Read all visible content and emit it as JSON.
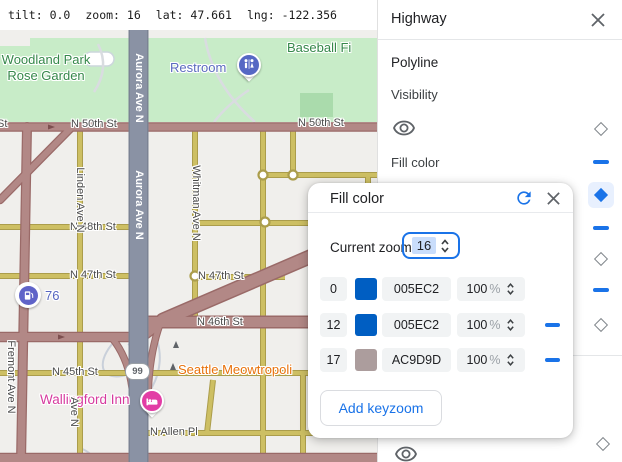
{
  "topbar": {
    "stats": [
      {
        "label": "tilt:",
        "value": "0.0"
      },
      {
        "label": "zoom:",
        "value": "16"
      },
      {
        "label": "lat:",
        "value": "47.661"
      },
      {
        "label": "lng:",
        "value": "-122.356"
      }
    ]
  },
  "panel": {
    "title": "Highway",
    "polyline_label": "Polyline",
    "visibility_label": "Visibility",
    "fill_color_label": "Fill color"
  },
  "dialog": {
    "title": "Fill color",
    "current_zoom_label": "Current zoom",
    "current_zoom_value": "16",
    "percent_suffix": "%",
    "add_button_label": "Add keyzoom",
    "rows": [
      {
        "zoom": "0",
        "hex": "005EC2",
        "swatch": "#005EC2",
        "opacity": "100",
        "removable": false
      },
      {
        "zoom": "12",
        "hex": "005EC2",
        "swatch": "#005EC2",
        "opacity": "100",
        "removable": true
      },
      {
        "zoom": "17",
        "hex": "AC9D9D",
        "swatch": "#AC9D9D",
        "opacity": "100",
        "removable": true
      }
    ]
  },
  "map": {
    "streets": {
      "aurora": "Aurora Ave N",
      "whitman": "Whitman Ave N",
      "linden": "Linden Ave N",
      "linden_short": "Ave N",
      "fremont": "Fremont Ave N",
      "n50": "N 50th St",
      "n50_partial": "St",
      "n48": "N 48th St",
      "n47": "N 47th St",
      "n46": "N 46th St",
      "n45": "N 45th St",
      "allen": "N Allen Pl",
      "route_shield": "99"
    },
    "places": {
      "park": "Woodland Park Rose Garden",
      "baseball": "Baseball Fi",
      "restroom": "Restroom",
      "cat_cafe": "Seattle Meowtropoli",
      "inn": "Wallingford Inn",
      "gas": "76"
    },
    "colors": {
      "highway_current": "#8A92A4",
      "arterial": "#B28886",
      "local": "#CDBF63",
      "park": "#C8ECC8",
      "accent": "#1A73E8"
    }
  }
}
